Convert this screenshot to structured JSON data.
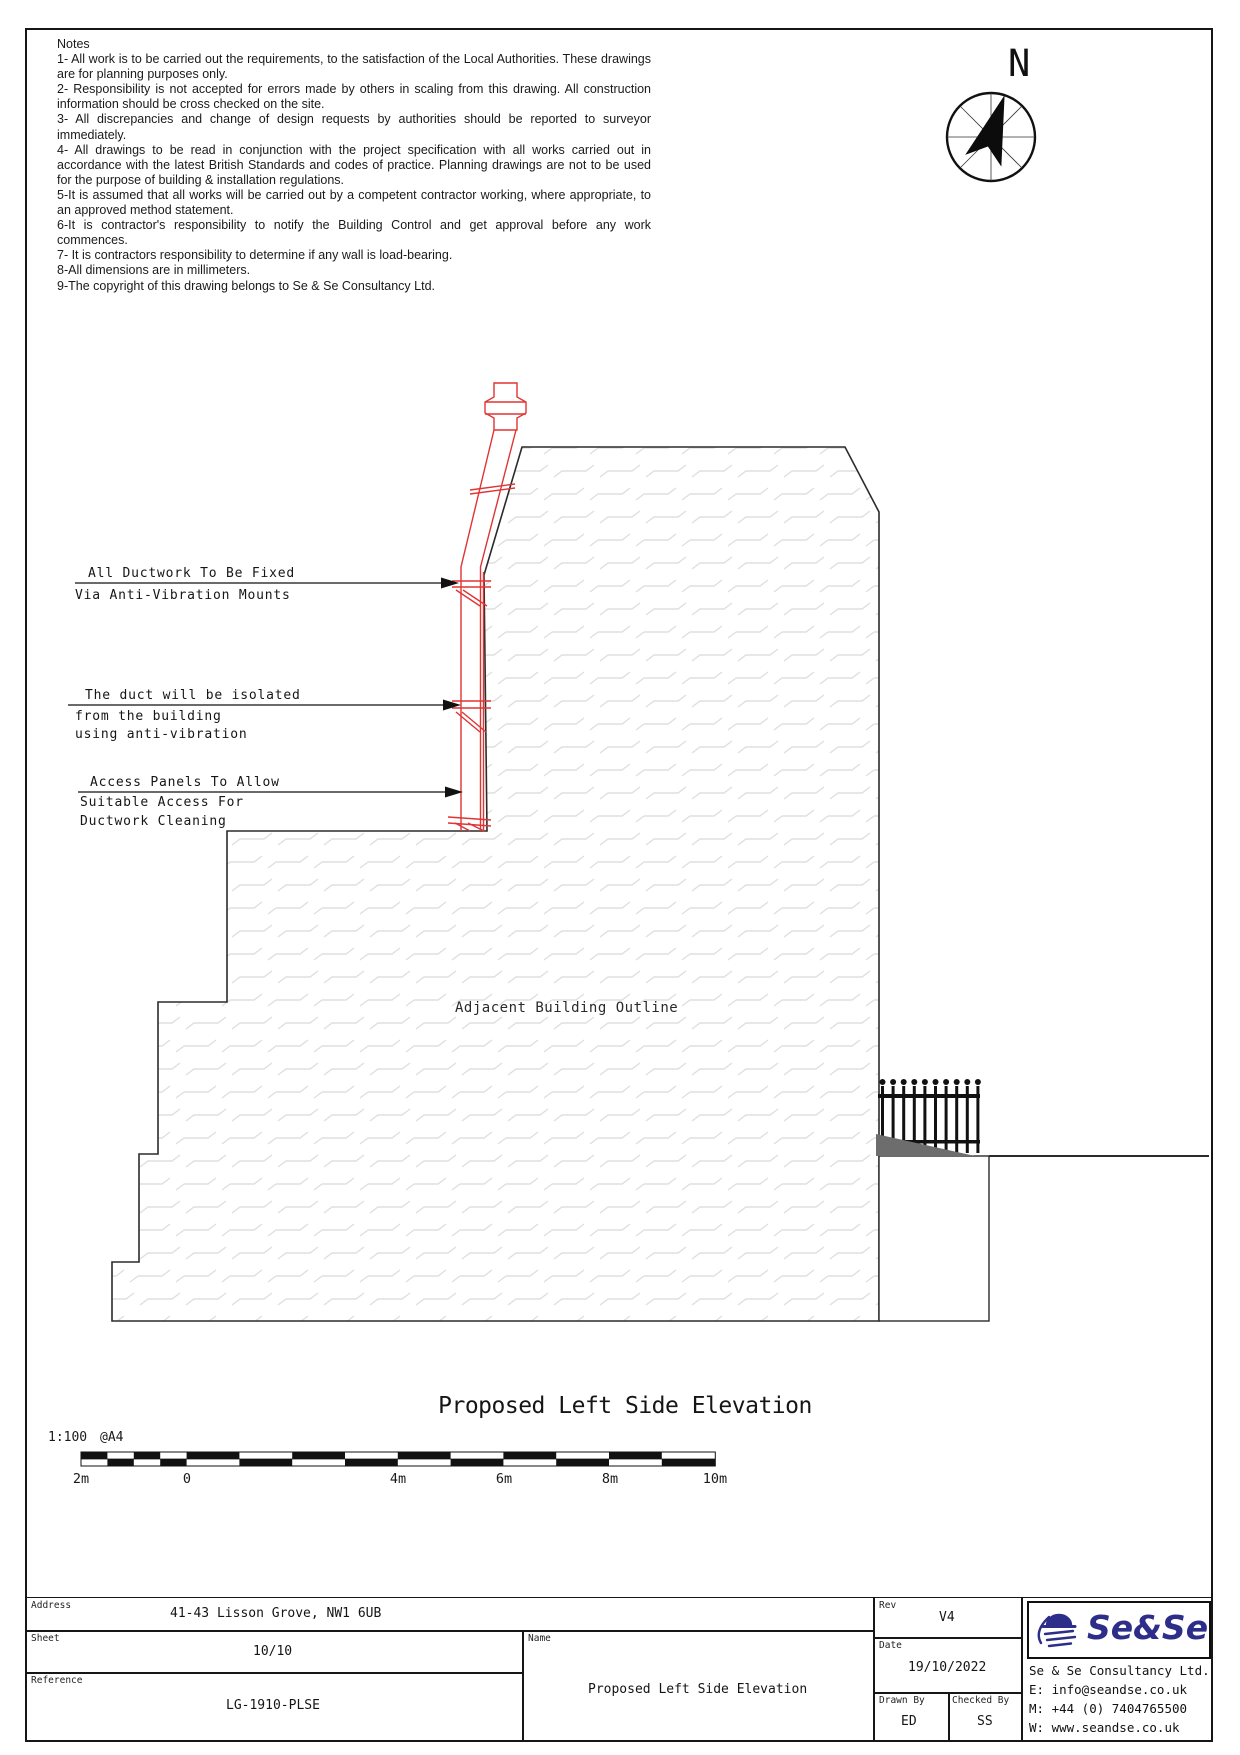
{
  "notes": {
    "heading": "Notes",
    "items": [
      "1- All work is to be carried out the requirements, to the satisfaction of the Local Authorities. These drawings are for planning purposes only.",
      "2- Responsibility is not accepted for errors made by others in scaling from this drawing. All construction information should be cross checked on the site.",
      "3- All discrepancies and change of design requests by authorities should be reported to surveyor immediately.",
      "4- All drawings to be read in conjunction with the project specification with all works carried out in accordance with the latest British Standards and codes of practice. Planning drawings are not to be used for the purpose of building & installation regulations.",
      "5-It is assumed that all works will be carried out by a competent contractor working, where appropriate, to an approved method statement.",
      "6-It is contractor's responsibility to notify the Building Control and get approval before any work commences.",
      "7- It is contractors responsibility to determine if any wall is load-bearing.",
      "8-All dimensions are in millimeters.",
      "9-The copyright of this drawing belongs to Se & Se Consultancy Ltd."
    ]
  },
  "compass": {
    "label": "N"
  },
  "annotations": {
    "duct_fixed": {
      "line1": "All Ductwork To Be Fixed",
      "line2": "Via Anti-Vibration Mounts"
    },
    "duct_isolated": {
      "line1": "The duct will be isolated",
      "line2": "from the building",
      "line3": "using anti-vibration"
    },
    "access_panels": {
      "line1": "Access Panels To Allow",
      "line2": "Suitable Access For",
      "line3": "Ductwork Cleaning"
    },
    "adjacent": "Adjacent Building Outline"
  },
  "drawing": {
    "title": "Proposed Left Side Elevation"
  },
  "scale_bar": {
    "ratio": "1:100",
    "paper": "@A4",
    "ticks": [
      "2m",
      "0",
      "4m",
      "6m",
      "8m",
      "10m"
    ]
  },
  "title_block": {
    "address": {
      "label": "Address",
      "value": "41-43 Lisson Grove, NW1 6UB"
    },
    "sheet": {
      "label": "Sheet",
      "value": "10/10"
    },
    "reference": {
      "label": "Reference",
      "value": "LG-1910-PLSE"
    },
    "name": {
      "label": "Name",
      "value": "Proposed Left Side Elevation"
    },
    "rev": {
      "label": "Rev",
      "value": "V4"
    },
    "date": {
      "label": "Date",
      "value": "19/10/2022"
    },
    "drawn_by": {
      "label": "Drawn By",
      "value": "ED"
    },
    "checked_by": {
      "label": "Checked By",
      "value": "SS"
    },
    "company": {
      "logo_text": "Se&Se",
      "name": "Se & Se Consultancy Ltd.",
      "email": "E: info@seandse.co.uk",
      "mobile": "M: +44 (0) 7404765500",
      "web": "W: www.seandse.co.uk"
    }
  },
  "colors": {
    "line": "#2b2b2b",
    "duct_red": "#e03434",
    "hatch": "#dfdfdf",
    "mound": "#6d6d6d",
    "logo_navy": "#2d2d8a"
  }
}
